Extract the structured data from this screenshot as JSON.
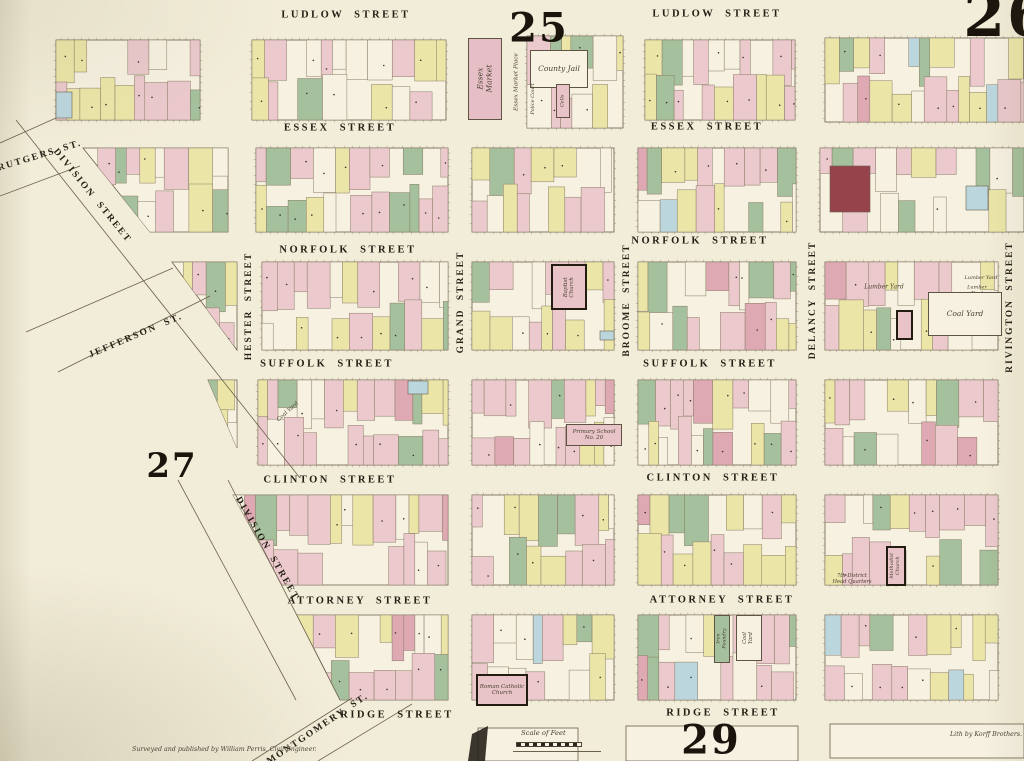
{
  "palette": {
    "page": "#f2edd8",
    "block_base": "#f6f1e1",
    "pink": "#ebc9cd",
    "yellow": "#ebe6a8",
    "cream": "#f6f1e1",
    "green": "#a5c09c",
    "rose": "#dfa9b4",
    "blue": "#bcd6de",
    "darkred": "#96434b",
    "lot_stroke": "#8a7c66",
    "block_stroke": "#6b604c",
    "ink": "#241e15",
    "script_ink": "#4a4130"
  },
  "plates": [
    {
      "id": "plate-25",
      "label": "25",
      "x": 539,
      "y": 28,
      "size": 40
    },
    {
      "id": "plate-26",
      "label": "26",
      "x": 1007,
      "y": 16,
      "size": 60
    },
    {
      "id": "plate-27",
      "label": "27",
      "x": 172,
      "y": 466,
      "size": 34
    },
    {
      "id": "plate-29",
      "label": "29",
      "x": 711,
      "y": 740,
      "size": 40
    }
  ],
  "streets": {
    "horizontal": [
      {
        "id": "ludlow-street-w",
        "label": "LUDLOW STREET",
        "x": 346,
        "y": 15
      },
      {
        "id": "ludlow-street-e",
        "label": "LUDLOW STREET",
        "x": 717,
        "y": 14
      },
      {
        "id": "essex-street-w",
        "label": "ESSEX STREET",
        "x": 340,
        "y": 128
      },
      {
        "id": "essex-street-e",
        "label": "ESSEX STREET",
        "x": 707,
        "y": 127
      },
      {
        "id": "norfolk-street-w",
        "label": "NORFOLK STREET",
        "x": 348,
        "y": 250
      },
      {
        "id": "norfolk-street-e",
        "label": "NORFOLK STREET",
        "x": 700,
        "y": 241
      },
      {
        "id": "suffolk-street-w",
        "label": "SUFFOLK STREET",
        "x": 327,
        "y": 364
      },
      {
        "id": "suffolk-street-e",
        "label": "SUFFOLK STREET",
        "x": 710,
        "y": 364
      },
      {
        "id": "clinton-street-w",
        "label": "CLINTON STREET",
        "x": 330,
        "y": 480
      },
      {
        "id": "clinton-street-e",
        "label": "CLINTON STREET",
        "x": 713,
        "y": 478
      },
      {
        "id": "attorney-street-w",
        "label": "ATTORNEY STREET",
        "x": 360,
        "y": 601
      },
      {
        "id": "attorney-street-e",
        "label": "ATTORNEY STREET",
        "x": 722,
        "y": 600
      },
      {
        "id": "ridge-street-w",
        "label": "RIDGE STREET",
        "x": 397,
        "y": 715
      },
      {
        "id": "ridge-street-e",
        "label": "RIDGE STREET",
        "x": 723,
        "y": 713
      }
    ],
    "vertical": [
      {
        "id": "hester-street",
        "label": "HESTER STREET",
        "x": 249,
        "y": 306,
        "rot": -90
      },
      {
        "id": "grand-street",
        "label": "GRAND STREET",
        "x": 461,
        "y": 302,
        "rot": -90
      },
      {
        "id": "broome-street",
        "label": "BROOME STREET",
        "x": 627,
        "y": 300,
        "rot": -90
      },
      {
        "id": "delancy-street",
        "label": "DELANCY STREET",
        "x": 813,
        "y": 300,
        "rot": -90
      },
      {
        "id": "rivington-street",
        "label": "RIVINGTON STREET",
        "x": 1010,
        "y": 307,
        "rot": -90
      }
    ],
    "diagonal": [
      {
        "id": "rutgers-st",
        "label": "RUTGERS ST.",
        "x": 40,
        "y": 156,
        "rot": -17
      },
      {
        "id": "division-street-upper",
        "label": "DIVISION STREET",
        "x": 92,
        "y": 196,
        "rot": 51
      },
      {
        "id": "jefferson-st",
        "label": "JEFFERSON ST.",
        "x": 136,
        "y": 336,
        "rot": -23
      },
      {
        "id": "division-street-lower",
        "label": "DIVISION STREET",
        "x": 267,
        "y": 549,
        "rot": 60
      },
      {
        "id": "montgomery-st",
        "label": "MONTGOMERY ST.",
        "x": 318,
        "y": 729,
        "rot": -34
      }
    ]
  },
  "landmarks": [
    {
      "id": "essex-market",
      "type": "bldg",
      "x": 468,
      "y": 38,
      "w": 34,
      "h": 82,
      "fill": "#e6bfc6",
      "border": "thin",
      "label": "Essex Market",
      "vertical": true,
      "fs": 7.5
    },
    {
      "id": "essex-market-place",
      "type": "text",
      "x": 517,
      "y": 82,
      "label": "Essex Market Place",
      "rot": -90,
      "fs": 5.8
    },
    {
      "id": "county-jail",
      "type": "bldg",
      "x": 530,
      "y": 50,
      "w": 58,
      "h": 38,
      "fill": "#f7f2e2",
      "border": "thin",
      "label": "County Jail",
      "fs": 7.5
    },
    {
      "id": "police-court",
      "type": "text",
      "x": 534,
      "y": 99,
      "label": "Police Court",
      "rot": -90,
      "fs": 5
    },
    {
      "id": "cells",
      "type": "bldg",
      "x": 556,
      "y": 84,
      "w": 14,
      "h": 34,
      "fill": "#e8c4c9",
      "border": "thin",
      "label": "Cells",
      "vertical": true,
      "fs": 5
    },
    {
      "id": "baptist-church",
      "type": "bldg",
      "x": 551,
      "y": 264,
      "w": 36,
      "h": 46,
      "fill": "#e8c4c9",
      "border": "thick",
      "label": "Baptist\nChurch",
      "vertical": true,
      "fs": 5.5
    },
    {
      "id": "mission-church",
      "type": "bldg",
      "x": 896,
      "y": 310,
      "w": 17,
      "h": 30,
      "fill": "#e8c4c9",
      "border": "thick",
      "label": "",
      "fs": 5
    },
    {
      "id": "lumber-yard-w",
      "type": "text",
      "x": 884,
      "y": 288,
      "label": "Lumber Yard",
      "fs": 6
    },
    {
      "id": "lumber-yard-e1",
      "type": "text",
      "x": 981,
      "y": 279,
      "label": "Lumber Yard",
      "fs": 5
    },
    {
      "id": "lumber-yard-e2",
      "type": "text",
      "x": 977,
      "y": 291,
      "label": "Lumber\nYard",
      "fs": 5
    },
    {
      "id": "coal-yard-e",
      "type": "bldg",
      "x": 928,
      "y": 292,
      "w": 74,
      "h": 44,
      "fill": "#f6f1e1",
      "border": "thin",
      "label": "Coal Yard",
      "fs": 7.5
    },
    {
      "id": "coal-yard-w",
      "type": "text",
      "x": 288,
      "y": 412,
      "label": "Coal Yard",
      "rot": -42,
      "fs": 5.5
    },
    {
      "id": "primary-school",
      "type": "bldg",
      "x": 566,
      "y": 424,
      "w": 56,
      "h": 22,
      "fill": "#e8c4c9",
      "border": "thin",
      "label": "Primary School\nNo. 20",
      "fs": 5.5
    },
    {
      "id": "methodist-church",
      "type": "bldg",
      "x": 886,
      "y": 546,
      "w": 20,
      "h": 40,
      "fill": "#e8c4c9",
      "border": "thick",
      "label": "Methodist\nChurch",
      "vertical": true,
      "fs": 5
    },
    {
      "id": "district-hq",
      "type": "text",
      "x": 852,
      "y": 580,
      "label": "7th District\nHead Quarters",
      "fs": 5.2
    },
    {
      "id": "iron-foundry",
      "type": "bldg",
      "x": 714,
      "y": 615,
      "w": 16,
      "h": 48,
      "fill": "#a5c09c",
      "border": "thin",
      "label": "Iron Foundry",
      "vertical": true,
      "fs": 4.8
    },
    {
      "id": "coal-yard-s",
      "type": "bldg",
      "x": 736,
      "y": 615,
      "w": 26,
      "h": 46,
      "fill": "#f6f1e1",
      "border": "thin",
      "label": "Coal Yard",
      "vertical": true,
      "fs": 5.2
    },
    {
      "id": "roman-catholic-church",
      "type": "bldg",
      "x": 476,
      "y": 674,
      "w": 52,
      "h": 32,
      "fill": "#e8c4c9",
      "border": "thick",
      "label": "Roman Catholic\nChurch",
      "fs": 5.5
    }
  ],
  "credits": {
    "surveyor": "Surveyed and published by William Perris, Civil Engineer.",
    "lith": "Lith by Korff Brothers.",
    "scale_label": "Scale of Feet"
  },
  "blocks": [
    {
      "id": "A1",
      "x": 56,
      "y": 40,
      "w": 144,
      "h": 80,
      "seed": 11
    },
    {
      "id": "A2",
      "x": 252,
      "y": 40,
      "w": 194,
      "h": 80,
      "seed": 12
    },
    {
      "id": "A3",
      "x": 527,
      "y": 36,
      "w": 96,
      "h": 92,
      "seed": 13
    },
    {
      "id": "A4",
      "x": 645,
      "y": 40,
      "w": 150,
      "h": 80,
      "seed": 14
    },
    {
      "id": "A5",
      "x": 825,
      "y": 38,
      "w": 199,
      "h": 84,
      "seed": 15
    },
    {
      "id": "B1",
      "poly": [
        [
          83,
          148
        ],
        [
          228,
          148
        ],
        [
          228,
          232
        ],
        [
          150,
          232
        ]
      ],
      "seed": 21
    },
    {
      "id": "B2",
      "x": 256,
      "y": 148,
      "w": 192,
      "h": 84,
      "seed": 22
    },
    {
      "id": "B3",
      "x": 472,
      "y": 148,
      "w": 142,
      "h": 84,
      "seed": 23
    },
    {
      "id": "B4",
      "x": 638,
      "y": 148,
      "w": 158,
      "h": 84,
      "seed": 24
    },
    {
      "id": "B5",
      "x": 820,
      "y": 148,
      "w": 204,
      "h": 84,
      "seed": 25
    },
    {
      "id": "C1",
      "poly": [
        [
          172,
          262
        ],
        [
          237,
          262
        ],
        [
          237,
          350
        ]
      ],
      "seed": 31
    },
    {
      "id": "C2",
      "x": 262,
      "y": 262,
      "w": 186,
      "h": 88,
      "seed": 32
    },
    {
      "id": "C3",
      "x": 472,
      "y": 262,
      "w": 142,
      "h": 88,
      "seed": 33
    },
    {
      "id": "C4",
      "x": 638,
      "y": 262,
      "w": 158,
      "h": 88,
      "seed": 34
    },
    {
      "id": "C5",
      "x": 825,
      "y": 262,
      "w": 173,
      "h": 88,
      "seed": 35
    },
    {
      "id": "D1",
      "poly": [
        [
          208,
          380
        ],
        [
          237,
          380
        ],
        [
          237,
          448
        ]
      ],
      "seed": 41
    },
    {
      "id": "D2",
      "x": 258,
      "y": 380,
      "w": 190,
      "h": 85,
      "seed": 42
    },
    {
      "id": "D3",
      "x": 472,
      "y": 380,
      "w": 142,
      "h": 85,
      "seed": 43
    },
    {
      "id": "D4",
      "x": 638,
      "y": 380,
      "w": 158,
      "h": 85,
      "seed": 44
    },
    {
      "id": "D5",
      "x": 825,
      "y": 380,
      "w": 173,
      "h": 85,
      "seed": 45
    },
    {
      "id": "E1",
      "poly": [
        [
          233,
          495
        ],
        [
          448,
          495
        ],
        [
          448,
          585
        ],
        [
          282,
          585
        ]
      ],
      "seed": 51
    },
    {
      "id": "E3",
      "x": 472,
      "y": 495,
      "w": 142,
      "h": 90,
      "seed": 53
    },
    {
      "id": "E4",
      "x": 638,
      "y": 495,
      "w": 158,
      "h": 90,
      "seed": 54
    },
    {
      "id": "E5",
      "x": 825,
      "y": 495,
      "w": 173,
      "h": 90,
      "seed": 55
    },
    {
      "id": "F2",
      "poly": [
        [
          297,
          615
        ],
        [
          448,
          615
        ],
        [
          448,
          700
        ],
        [
          340,
          700
        ]
      ],
      "seed": 61
    },
    {
      "id": "F3",
      "x": 472,
      "y": 615,
      "w": 142,
      "h": 85,
      "seed": 63
    },
    {
      "id": "F4",
      "x": 638,
      "y": 615,
      "w": 158,
      "h": 85,
      "seed": 64
    },
    {
      "id": "F5",
      "x": 825,
      "y": 615,
      "w": 173,
      "h": 85,
      "seed": 65
    },
    {
      "id": "G0",
      "x": 478,
      "y": 728,
      "w": 100,
      "h": 33,
      "empty": true
    },
    {
      "id": "G1",
      "x": 626,
      "y": 726,
      "w": 172,
      "h": 35,
      "empty": true
    },
    {
      "id": "G2",
      "x": 830,
      "y": 724,
      "w": 194,
      "h": 34,
      "empty": true
    }
  ],
  "extras": [
    {
      "x": 56,
      "y": 92,
      "w": 16,
      "h": 26,
      "color": "blue"
    },
    {
      "x": 830,
      "y": 166,
      "w": 40,
      "h": 46,
      "color": "darkred"
    },
    {
      "x": 966,
      "y": 186,
      "w": 22,
      "h": 24,
      "color": "blue"
    },
    {
      "x": 408,
      "y": 381,
      "w": 20,
      "h": 13,
      "color": "blue"
    },
    {
      "x": 600,
      "y": 331,
      "w": 14,
      "h": 9,
      "color": "blue"
    }
  ],
  "edge_lines": [
    [
      0,
      143,
      56,
      118
    ],
    [
      0,
      196,
      80,
      166
    ],
    [
      26,
      332,
      173,
      268
    ],
    [
      58,
      372,
      210,
      296
    ],
    [
      16,
      120,
      300,
      478
    ],
    [
      178,
      480,
      296,
      700
    ],
    [
      228,
      480,
      340,
      700
    ],
    [
      252,
      761,
      352,
      698
    ],
    [
      318,
      761,
      412,
      704
    ]
  ],
  "wedge": [
    [
      472,
      734
    ],
    [
      488,
      726
    ],
    [
      485,
      761
    ],
    [
      468,
      761
    ]
  ]
}
